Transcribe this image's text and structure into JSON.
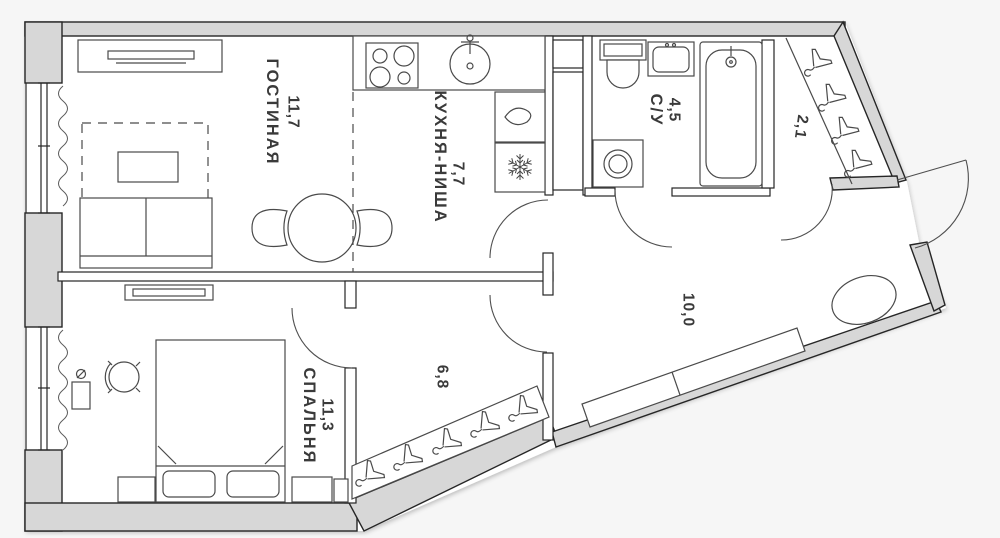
{
  "plan_title": "Apartment floor plan",
  "rooms": {
    "living": {
      "name": "ГОСТИНАЯ",
      "area": "11,7"
    },
    "kitchen": {
      "name": "КУХНЯ-НИША",
      "area": "7,7"
    },
    "bathroom": {
      "name": "С/У",
      "area": "4,5"
    },
    "bedroom": {
      "name": "СПАЛЬНЯ",
      "area": "11,3"
    },
    "hallway": {
      "area": "10,0"
    },
    "corridor": {
      "area": "6,8"
    },
    "wardrobe": {
      "area": "2,1"
    }
  },
  "icons": {
    "fridge": "snowflake-icon",
    "kettle": "water-drop-icon",
    "closet": "hanger-icon"
  },
  "colors": {
    "wall_fill": "#d7d7d7",
    "wall_line": "#262626",
    "furniture_line": "#4a4a4a",
    "label_color": "#3a3a3a",
    "floor": "#ffffff",
    "page_bg": "#f6f6f6"
  }
}
